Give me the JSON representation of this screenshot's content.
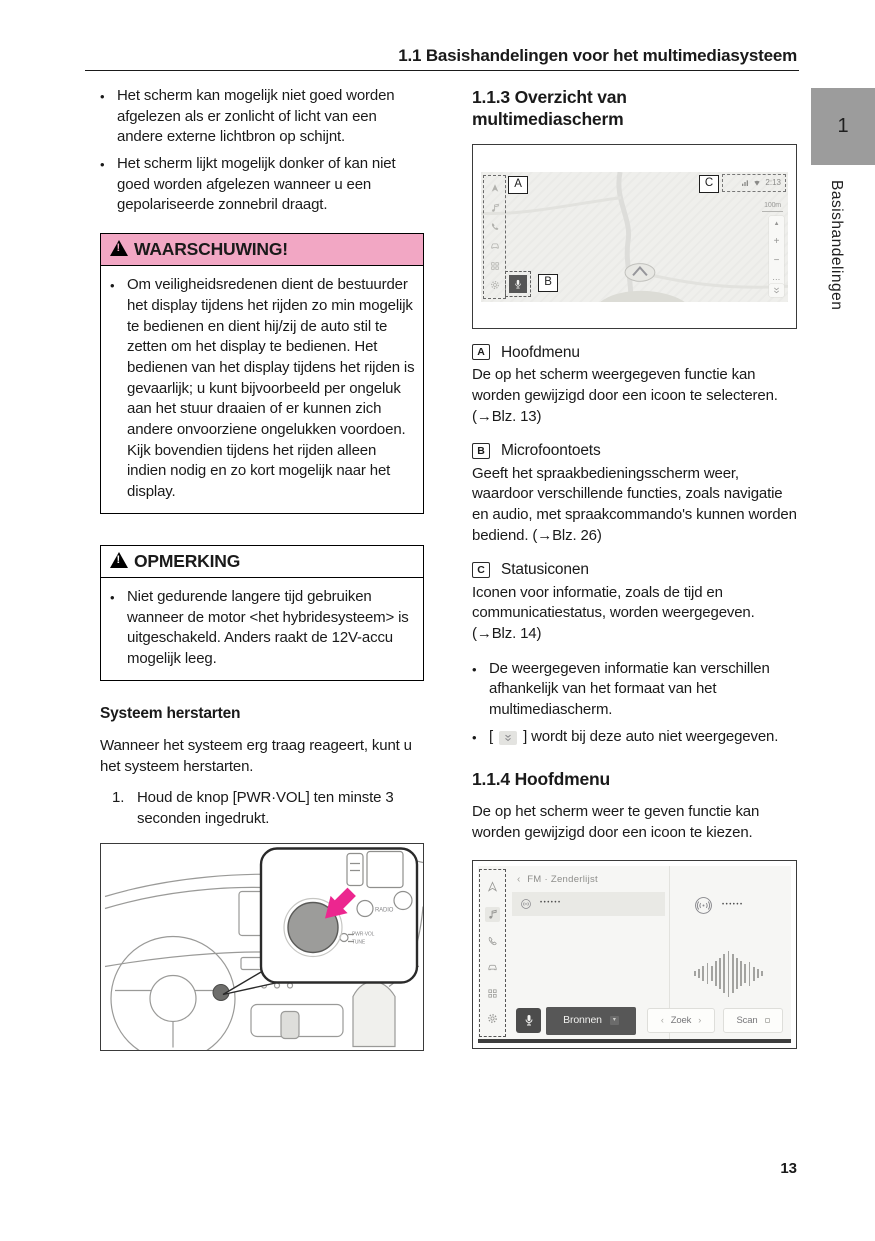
{
  "page": {
    "header_title": "1.1  Basishandelingen voor het multimediasysteem",
    "chapter_tab": "1",
    "side_label": "Basishandelingen",
    "page_number": "13"
  },
  "colors": {
    "warning_band_pink": "#f2a7c4",
    "chapter_tab_gray": "#9c9c9c",
    "accent_arrow_pink": "#ec268f"
  },
  "icons": {
    "warning_triangle": "black triangle with exclamation",
    "nav_arrow": "navigation-arrow",
    "music_note": "music-note",
    "phone": "phone-handset",
    "car": "car",
    "apps_grid": "grid",
    "gear": "settings-gear",
    "microphone": "microphone",
    "double_chevron_down": "double-chevron-down",
    "radio_waves": "radio-broadcast"
  },
  "left_column": {
    "bullets": [
      "Het scherm kan mogelijk niet goed worden afgelezen als er zonlicht of licht van een andere externe lichtbron op schijnt.",
      "Het scherm lijkt mogelijk donker of kan niet goed worden afgelezen wanneer u een gepolariseerde zonnebril draagt."
    ],
    "warning_box": {
      "title": "WAARSCHUWING!",
      "bullet": "Om veiligheidsredenen dient de bestuurder het display tijdens het rijden zo min mogelijk te bedienen en dient hij/zij de auto stil te zetten om het display te bedienen. Het bedienen van het display tijdens het rijden is gevaarlijk; u kunt bijvoorbeeld per ongeluk aan het stuur draaien of er kunnen zich andere onvoorziene ongelukken voordoen. Kijk bovendien tijdens het rijden alleen indien nodig en zo kort mogelijk naar het display."
    },
    "note_box": {
      "title": "OPMERKING",
      "bullet": "Niet gedurende langere tijd gebruiken wanneer de motor <het hybridesysteem> is uitgeschakeld. Anders raakt de 12V-accu mogelijk leeg."
    },
    "restart": {
      "heading": "Systeem herstarten",
      "intro": "Wanneer het systeem erg traag reageert, kunt u het systeem herstarten.",
      "step_number": "1.",
      "step_text": "Houd de knop [PWR·VOL] ten minste 3 seconden ingedrukt."
    },
    "dashboard_figure": {
      "label_radio": "RADIO",
      "label_pwrvol": "PWR·VOL",
      "label_tune": "TUNE"
    }
  },
  "right_column": {
    "section_113_heading": "1.1.3  Overzicht van multimediascherm",
    "screen_figure": {
      "callout_a": "A",
      "callout_b": "B",
      "callout_c": "C",
      "clock": "2:13",
      "scale": "100m",
      "ctrl_up": "▲",
      "ctrl_plus": "+",
      "ctrl_minus": "−",
      "ctrl_more": "⋯"
    },
    "items": [
      {
        "key": "A",
        "title": "Hoofdmenu",
        "body": "De op het scherm weergegeven functie kan worden gewijzigd door een icoon te selecteren. (→Blz. 13)"
      },
      {
        "key": "B",
        "title": "Microfoontoets",
        "body": "Geeft het spraakbedieningsscherm weer, waardoor verschillende functies, zoals navigatie en audio, met spraakcommando's kunnen worden bediend. (→Blz. 26)"
      },
      {
        "key": "C",
        "title": "Statusiconen",
        "body": "Iconen voor informatie, zoals de tijd en communicatiestatus, worden weergegeven. (→Blz. 14)"
      }
    ],
    "bullets": [
      "De weergegeven informatie kan verschillen afhankelijk van het formaat van het multimediascherm."
    ],
    "bullet_icon_prefix": "[",
    "bullet_icon_suffix": "] wordt bij deze auto niet weergegeven.",
    "section_114_heading": "1.1.4  Hoofdmenu",
    "section_114_body": "De op het scherm weer te geven functie kan worden gewijzigd door een icoon te kiezen.",
    "fm_figure": {
      "back_chevron": "‹",
      "breadcrumb": "FM · Zenderlijst",
      "list_dots": "••••••",
      "source_dots": "••••••",
      "bronnen_label": "Bronnen",
      "dd_glyph": "▾",
      "zoek_label": "Zoek",
      "zoek_left": "‹",
      "zoek_right": "›",
      "scan_label": "Scan",
      "wave_bars": [
        5,
        9,
        15,
        21,
        15,
        25,
        31,
        39,
        46,
        39,
        31,
        25,
        19,
        24,
        14,
        9,
        5
      ]
    }
  }
}
